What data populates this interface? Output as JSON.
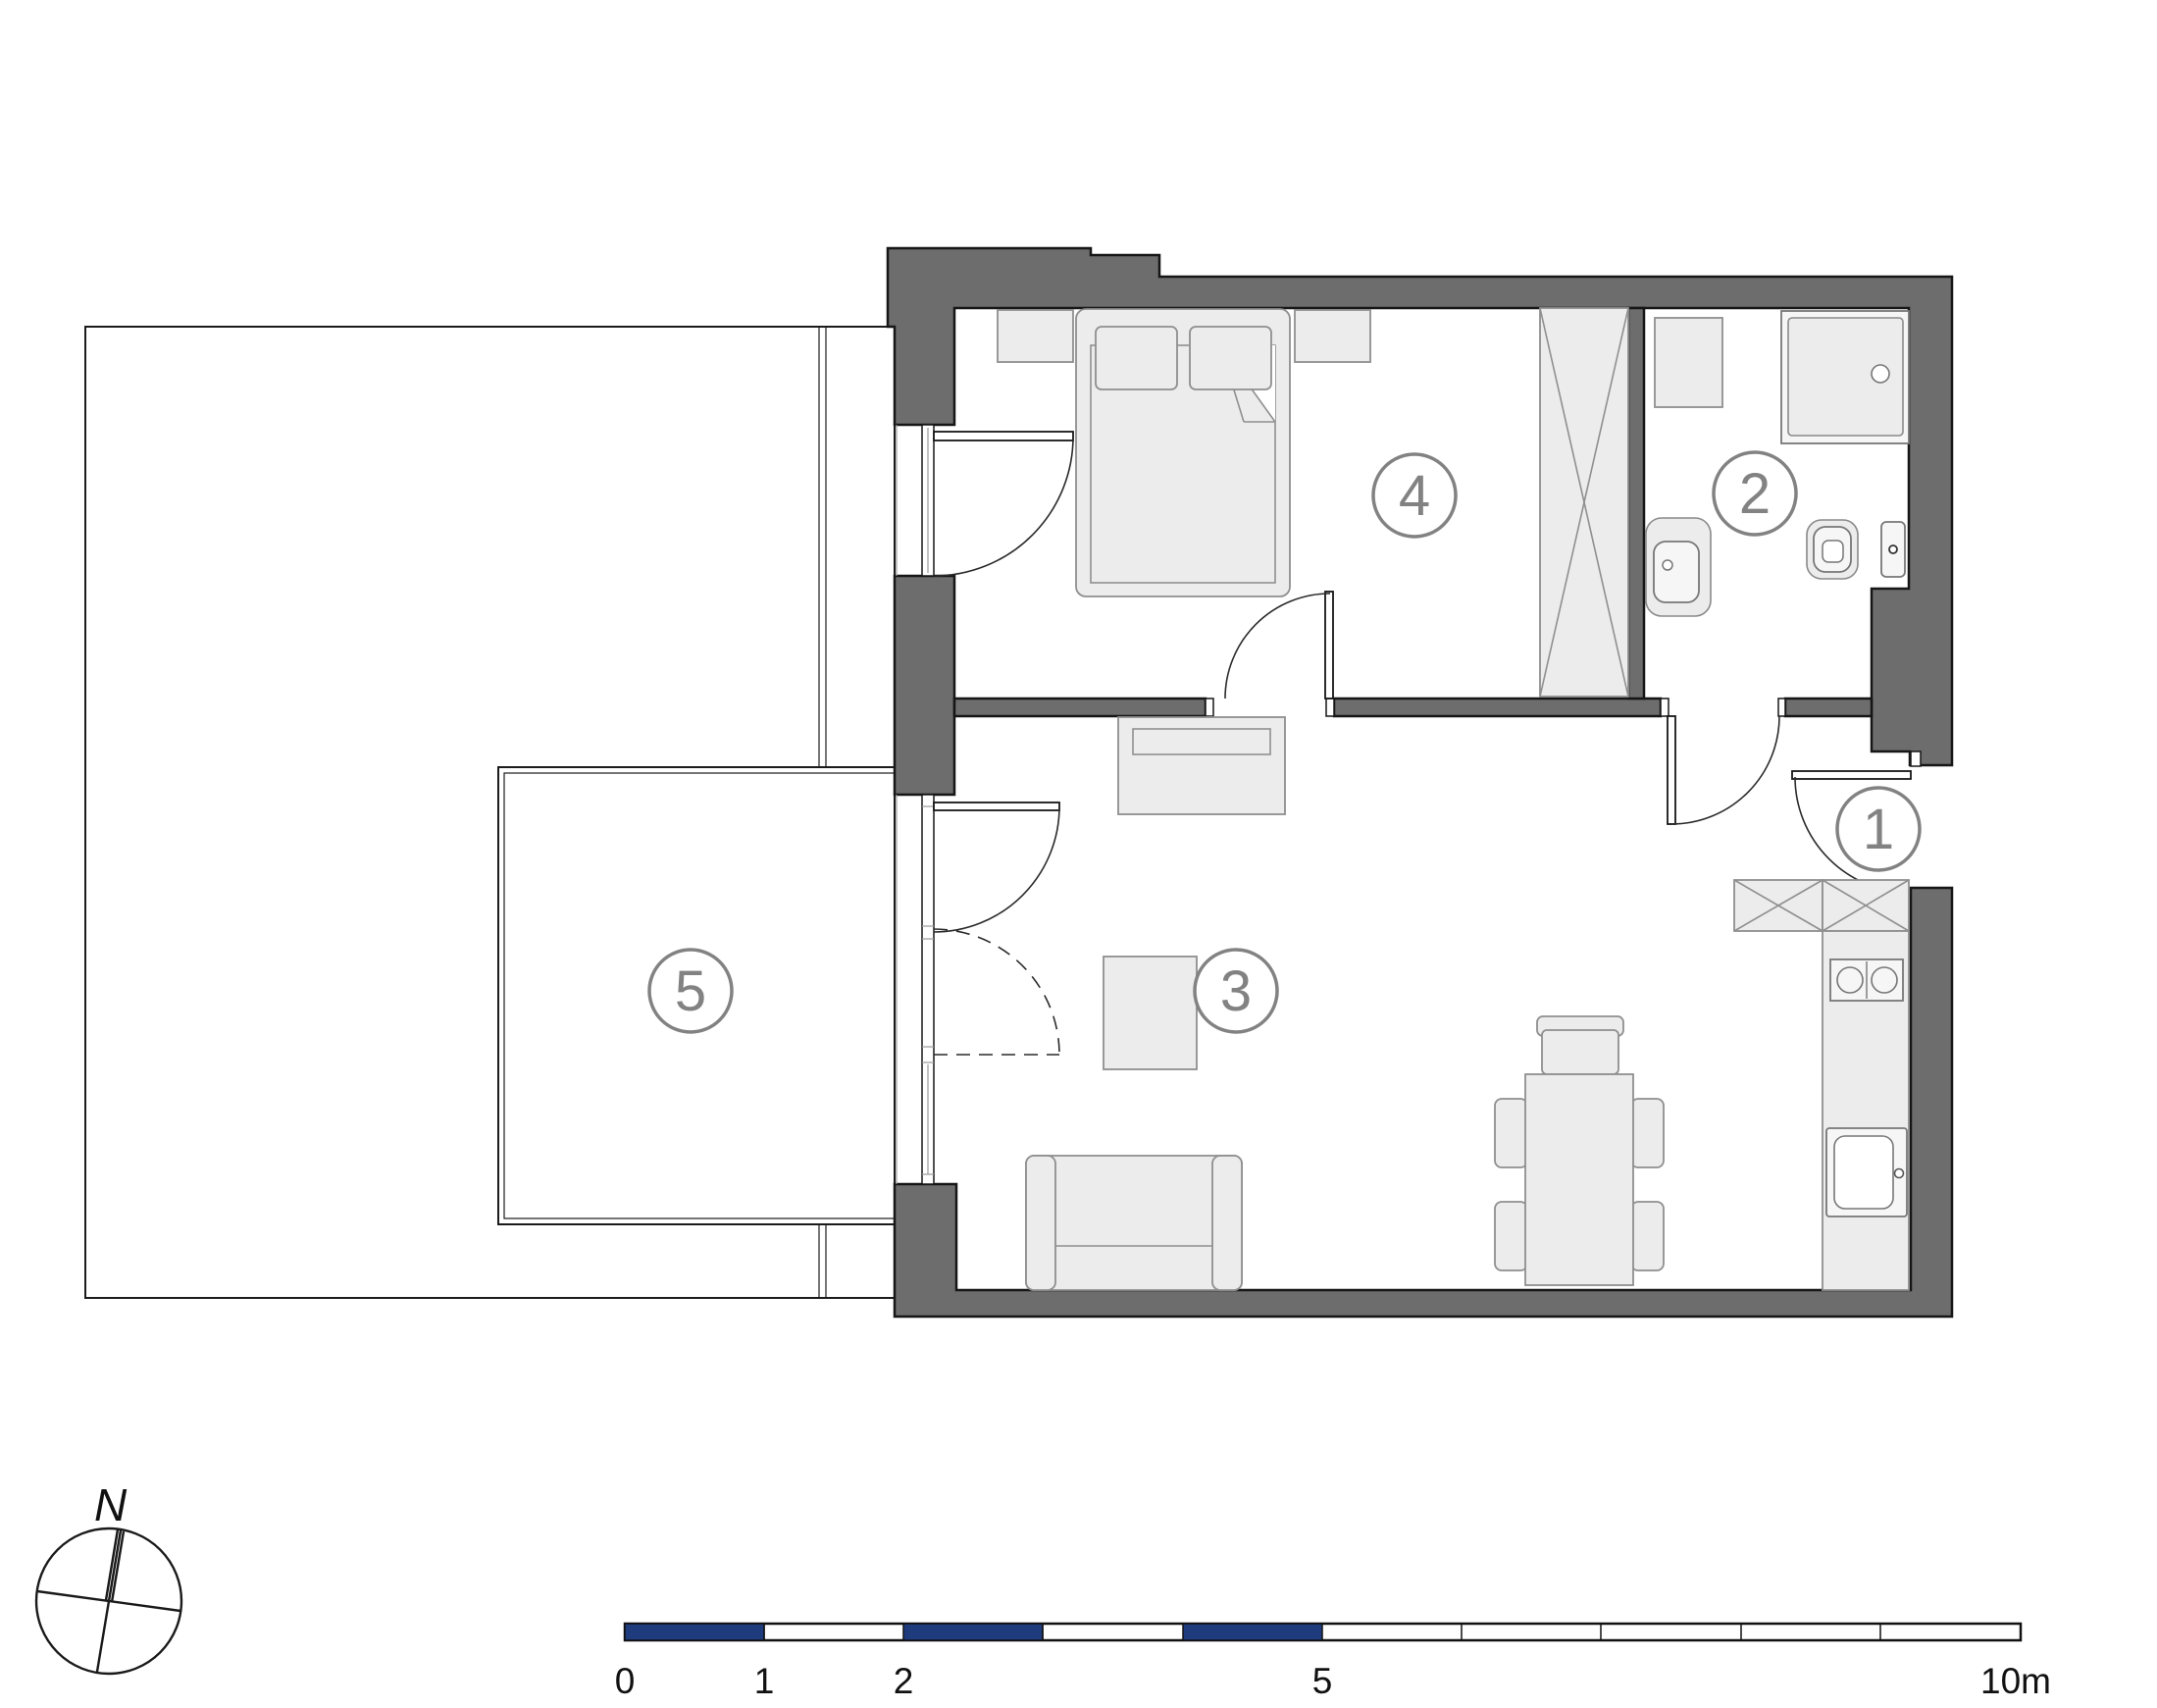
{
  "rooms": [
    {
      "number": "1"
    },
    {
      "number": "2"
    },
    {
      "number": "3"
    },
    {
      "number": "4"
    },
    {
      "number": "5"
    }
  ],
  "compass": {
    "north_label": "N"
  },
  "scale_bar": {
    "tick_labels": [
      "0",
      "1",
      "2",
      "5",
      "10m"
    ]
  },
  "icons": {
    "north_arrow": "compass rose with tilted cross",
    "wardrobe": "crossed box",
    "kitchen_cabinets": "crossed boxes"
  },
  "colors": {
    "wall": "#6d6d6d",
    "outline": "#161616",
    "furniture_fill": "#ececec",
    "furniture_stroke": "#8f8f8f",
    "boundary": "#1b1b1b",
    "label_gray": "#828282",
    "scale_blue": "#1e3c7d"
  }
}
